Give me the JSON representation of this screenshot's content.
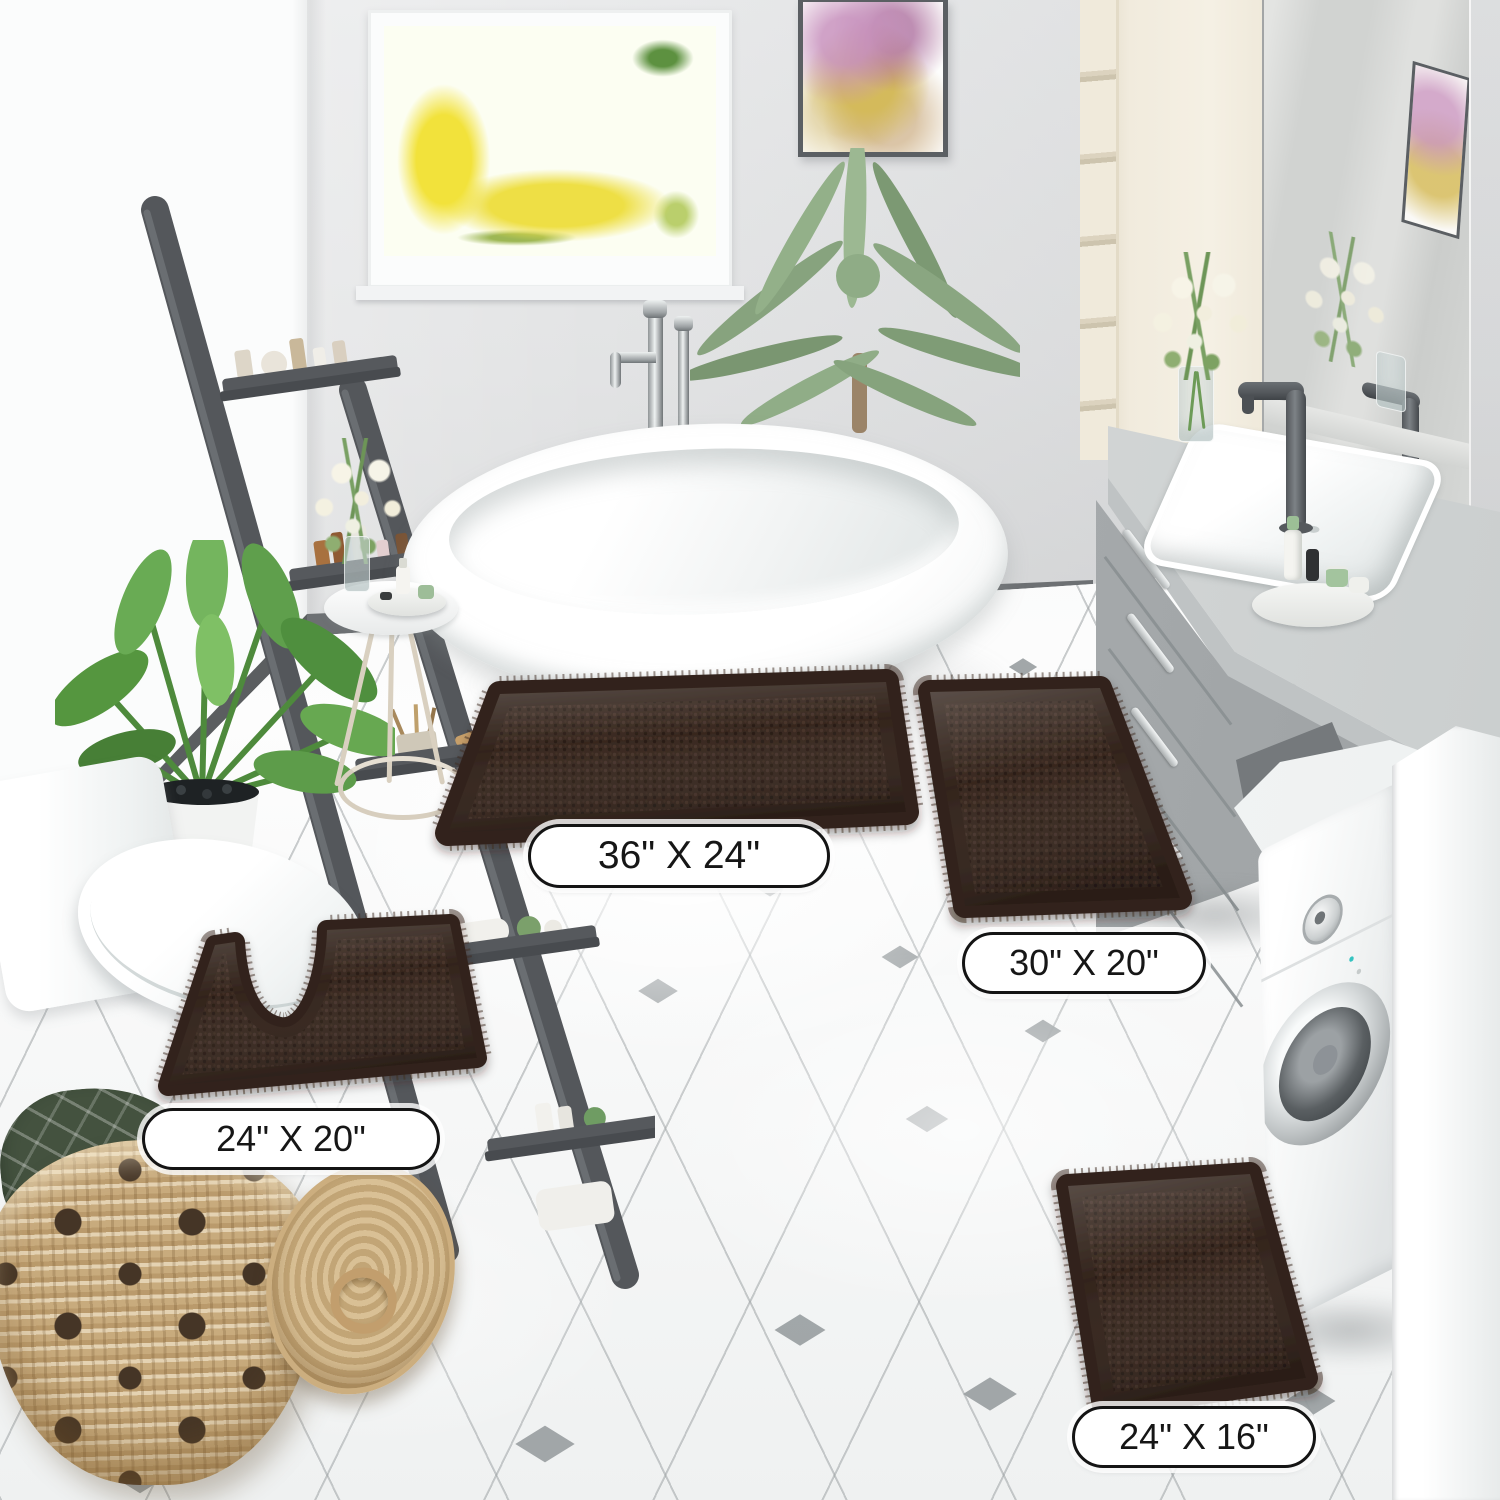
{
  "labels": {
    "rug_36x24": "36\" X 24\"",
    "rug_30x20": "30\" X 20\"",
    "rug_24x20": "24\" X 20\"",
    "rug_24x16": "24\" X 16\""
  },
  "colors": {
    "rug_brown": "#3a2a21",
    "rug_brown_dark": "#2a1d16",
    "rug_brown_light": "#47332a",
    "floor_white": "#f4f5f5",
    "grout_gray": "#9ea3a5",
    "accent_diamond_gray": "#9aa0a2",
    "wall_gray": "#e4e5e6",
    "baseboard_gray": "#6d7073",
    "vanity_gray": "#b6babc",
    "cabinet_cream": "#f1ebdd",
    "ladder_gray": "#54575b",
    "plant_green": "#5f9e4c",
    "window_foliage_yellow": "#f2e23b",
    "basket_tan": "#c8ab7d",
    "towel_green": "#44523f",
    "label_bg": "#ffffff",
    "label_border": "#141414",
    "label_text": "#161616"
  }
}
